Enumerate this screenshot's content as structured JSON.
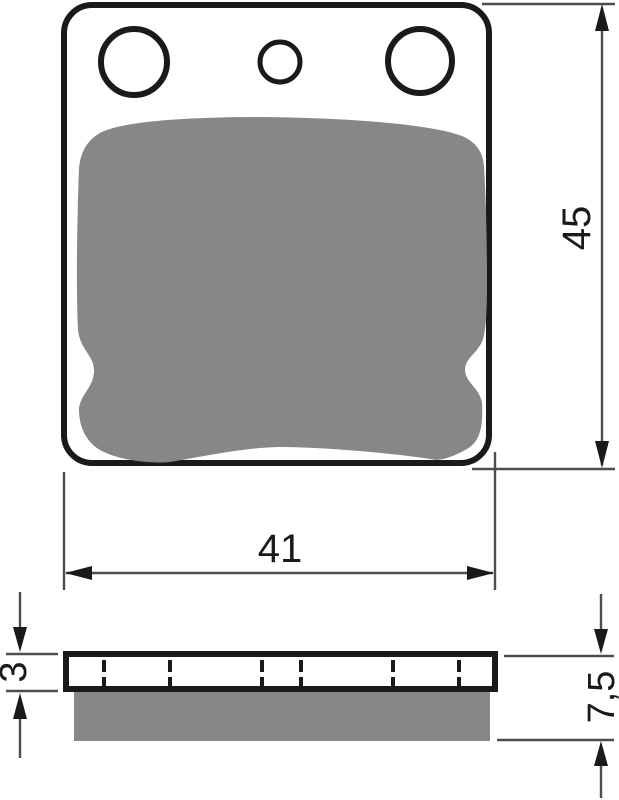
{
  "drawing": {
    "subject": "brake-pad-technical-drawing",
    "views": {
      "top": "pad face view",
      "side": "pad profile view"
    },
    "features": {
      "large_mounting_holes": 2,
      "small_center_hole": 1,
      "hidden_hole_lines_in_profile": 6
    },
    "dimensions": {
      "pad_height": {
        "label": "45",
        "orientation": "vertical"
      },
      "pad_width": {
        "label": "41",
        "orientation": "horizontal"
      },
      "backplate_thickness": {
        "label": "3",
        "orientation": "vertical"
      },
      "total_thickness": {
        "label": "7,5",
        "orientation": "vertical"
      }
    },
    "colors": {
      "friction_material": "#878787",
      "outline": "#1a1a1a",
      "dimension_line": "#4d4d4d",
      "background": "#ffffff"
    }
  }
}
